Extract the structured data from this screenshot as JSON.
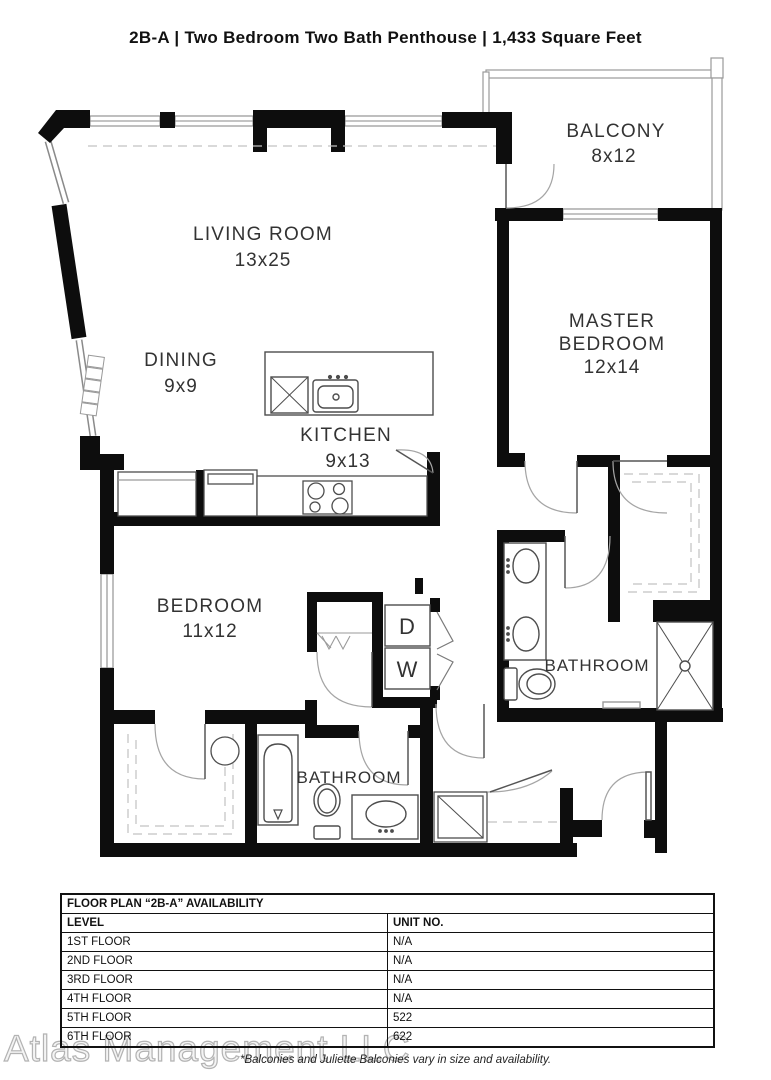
{
  "title": "2B-A  |  Two Bedroom Two Bath Penthouse  |  1,433 Square Feet",
  "rooms": {
    "living": {
      "name": "LIVING ROOM",
      "dims": "13x25"
    },
    "dining": {
      "name": "DINING",
      "dims": "9x9"
    },
    "kitchen": {
      "name": "KITCHEN",
      "dims": "9x13"
    },
    "balcony": {
      "name": "BALCONY",
      "dims": "8x12"
    },
    "master": {
      "name_line1": "MASTER",
      "name_line2": "BEDROOM",
      "dims": "12x14"
    },
    "bedroom": {
      "name": "BEDROOM",
      "dims": "11x12"
    },
    "bath_master": {
      "name": "BATHROOM"
    },
    "bath_second": {
      "name": "BATHROOM"
    },
    "dryer": "D",
    "washer": "W"
  },
  "availability": {
    "title": "FLOOR PLAN “2B-A” AVAILABILITY",
    "columns": [
      "LEVEL",
      "UNIT NO."
    ],
    "rows": [
      {
        "level": "1ST FLOOR",
        "unit": "N/A"
      },
      {
        "level": "2ND FLOOR",
        "unit": "N/A"
      },
      {
        "level": "3RD FLOOR",
        "unit": "N/A"
      },
      {
        "level": "4TH FLOOR",
        "unit": "N/A"
      },
      {
        "level": "5TH FLOOR",
        "unit": "522"
      },
      {
        "level": "6TH FLOOR",
        "unit": "622"
      }
    ]
  },
  "footer": {
    "watermark": "Atlas Management LLC",
    "disclaimer": "*Balconies and Juliette Balconies vary in size and availability."
  }
}
